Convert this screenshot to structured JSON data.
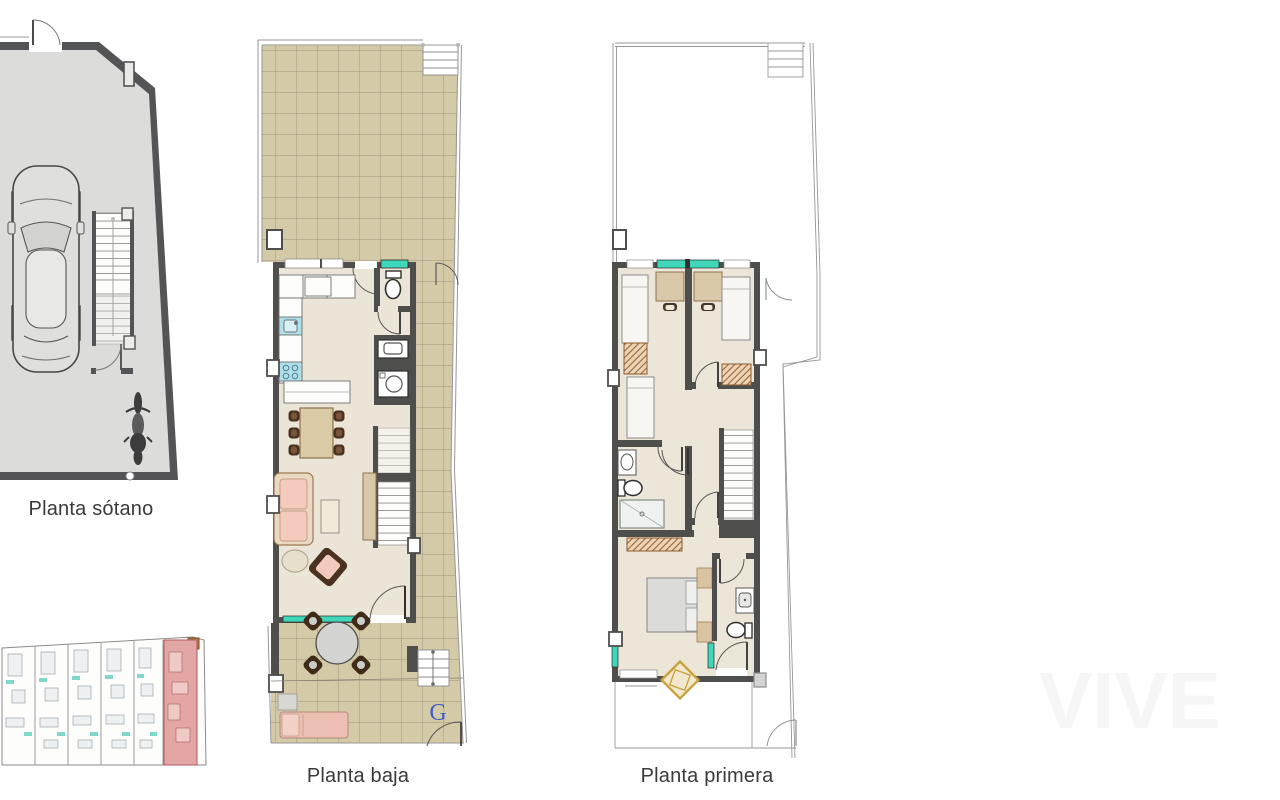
{
  "page": {
    "background": "#ffffff",
    "width": 1280,
    "height": 800
  },
  "plans": {
    "basement": {
      "label": "Planta sótano"
    },
    "ground_floor": {
      "label": "Planta baja",
      "garage_letter": "G"
    },
    "first_floor": {
      "label": "Planta primera"
    }
  },
  "site_plan": {
    "units_total": 6,
    "highlighted_unit": 6,
    "highlight_color": "#e2a6a4"
  },
  "watermark": {
    "text": "VIVE"
  },
  "colors": {
    "wall_dark": "#4e4e4c",
    "basement_floor": "#dcddda",
    "terrace_tile": "#d5caa7",
    "tile_grid_line": "#9b937d",
    "interior_floor": "#ebe5d7",
    "window_teal": "#3fd7ba",
    "sofa_pink": "#f3cabb",
    "lounger_pink": "#edbfb2",
    "furniture_tan": "#d9c9a8",
    "furniture_brown": "#4a3120",
    "wardrobe_hatch": "#8a5a30",
    "fixture_blue": "#aee0ea",
    "bed_gray": "#dbdcd9",
    "rug_gold": "#c9a43e",
    "garage_letter_blue": "#3f5fc8",
    "label_text": "#3a3a3a",
    "thin_outline": "#979797",
    "site_highlight": "#e2a6a4"
  },
  "icons": {
    "car-icon": "top view car",
    "motorcycle-icon": "top view motorcycle",
    "staircase": "stair flight with treads",
    "toilet-icon": "toilet top view",
    "sink-icon": "washbasin top view",
    "shower-icon": "shower tray",
    "washer-icon": "washing machine",
    "bed-icon": "bed top view",
    "wardrobe-icon": "hatched wardrobe",
    "table-icon": "dining table with chairs",
    "sofa-icon": "sofa top view",
    "lounger-icon": "sun lounger",
    "rug-icon": "rug"
  }
}
